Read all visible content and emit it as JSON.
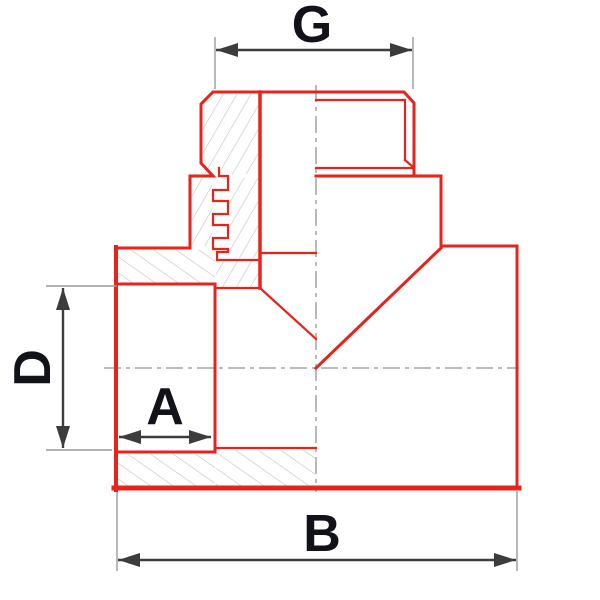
{
  "diagram": {
    "type": "technical-drawing",
    "description": "Half-section drawing of a threaded tee pipe fitting with dimension callouts",
    "labels": {
      "top_thread_dimension": "G",
      "left_bore_dimension": "D",
      "socket_depth_dimension": "A",
      "overall_width_dimension": "B"
    },
    "colors": {
      "outline": "#e8231c",
      "dimension": "#3c3c3c",
      "extension": "#9a9a9a",
      "centerline": "#b3b3b3",
      "hatch": "#c2c2c2",
      "label_text": "#12121a",
      "background": "#ffffff"
    }
  }
}
